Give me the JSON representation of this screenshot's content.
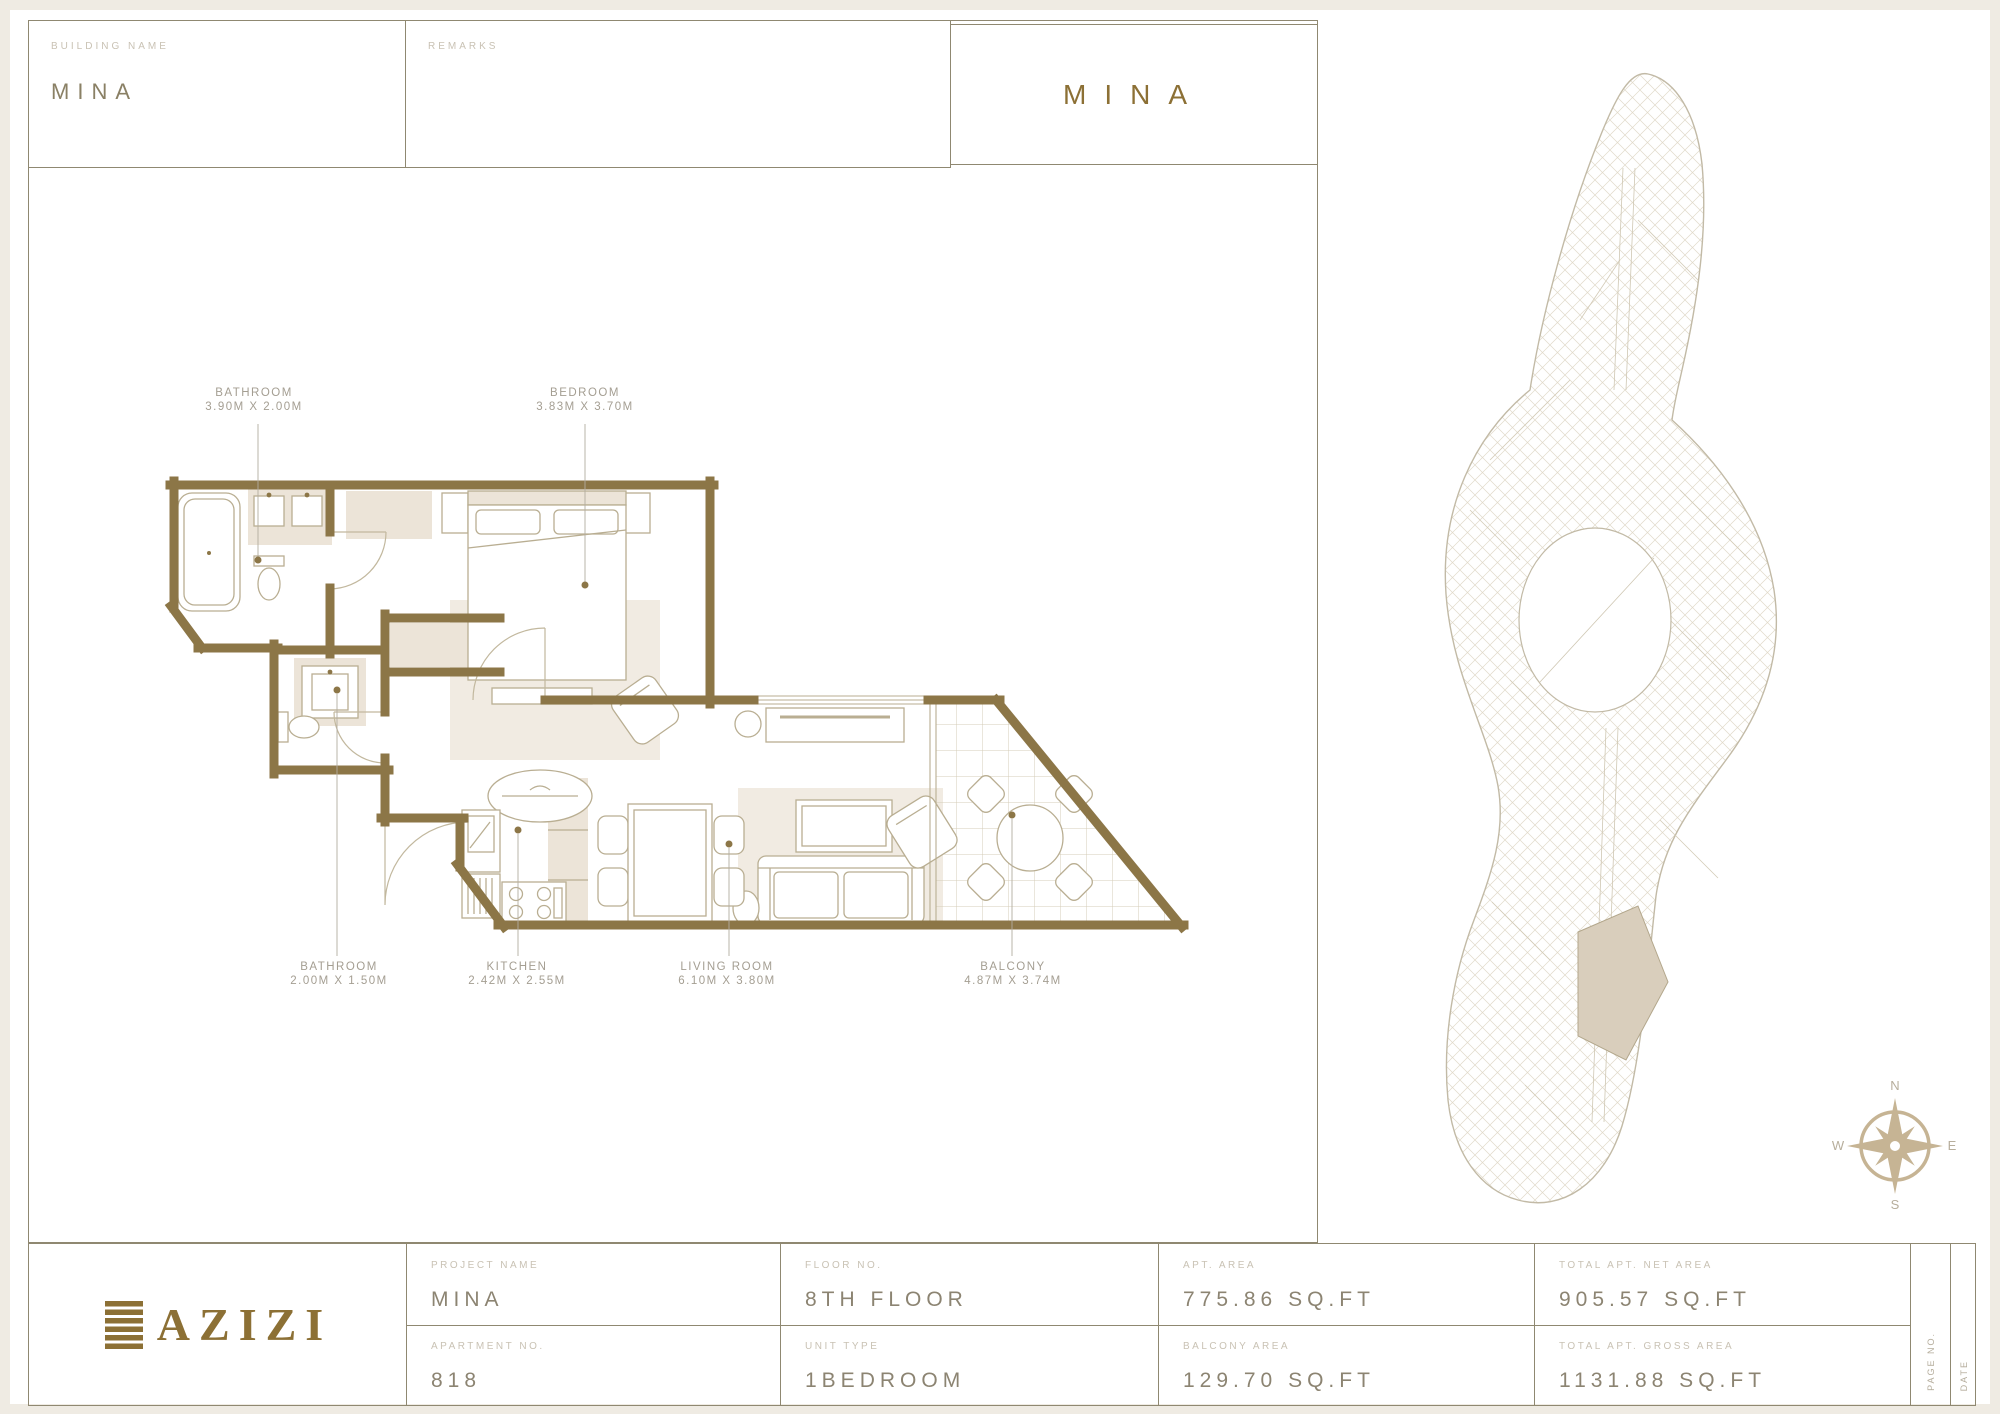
{
  "colors": {
    "accent_gold": "#8c7035",
    "wall_brown": "#8c7647",
    "beige_fill": "#ece4d8",
    "line_tan": "#b9ae92",
    "border_olive": "#8f8871",
    "label_gray": "#c9c2b4",
    "value_gray": "#8c8472"
  },
  "header": {
    "building_name_label": "BUILDING NAME",
    "building_name_value": "MINA",
    "remarks_label": "REMARKS",
    "title": "MINA"
  },
  "plan_labels": [
    {
      "name": "BATHROOM",
      "dims": "3.90M X 2.00M"
    },
    {
      "name": "BEDROOM",
      "dims": "3.83M X 3.70M"
    },
    {
      "name": "BATHROOM",
      "dims": "2.00M X 1.50M"
    },
    {
      "name": "KITCHEN",
      "dims": "2.42M X 2.55M"
    },
    {
      "name": "LIVING ROOM",
      "dims": "6.10M X 3.80M"
    },
    {
      "name": "BALCONY",
      "dims": "4.87M X 3.74M"
    }
  ],
  "compass": {
    "n": "N",
    "e": "E",
    "s": "S",
    "w": "W"
  },
  "footer": {
    "logo_text": "AZIZI",
    "cells": [
      {
        "label": "PROJECT NAME",
        "value": "MINA"
      },
      {
        "label": "APARTMENT NO.",
        "value": "818"
      },
      {
        "label": "FLOOR NO.",
        "value": "8TH FLOOR"
      },
      {
        "label": "UNIT TYPE",
        "value": "1BEDROOM"
      },
      {
        "label": "APT. AREA",
        "value": "775.86 SQ.FT"
      },
      {
        "label": "BALCONY AREA",
        "value": "129.70 SQ.FT"
      },
      {
        "label": "TOTAL APT. NET AREA",
        "value": "905.57 SQ.FT"
      },
      {
        "label": "TOTAL APT. GROSS AREA",
        "value": "1131.88 SQ.FT"
      }
    ],
    "page_no_label": "PAGE NO.",
    "date_label": "DATE"
  }
}
